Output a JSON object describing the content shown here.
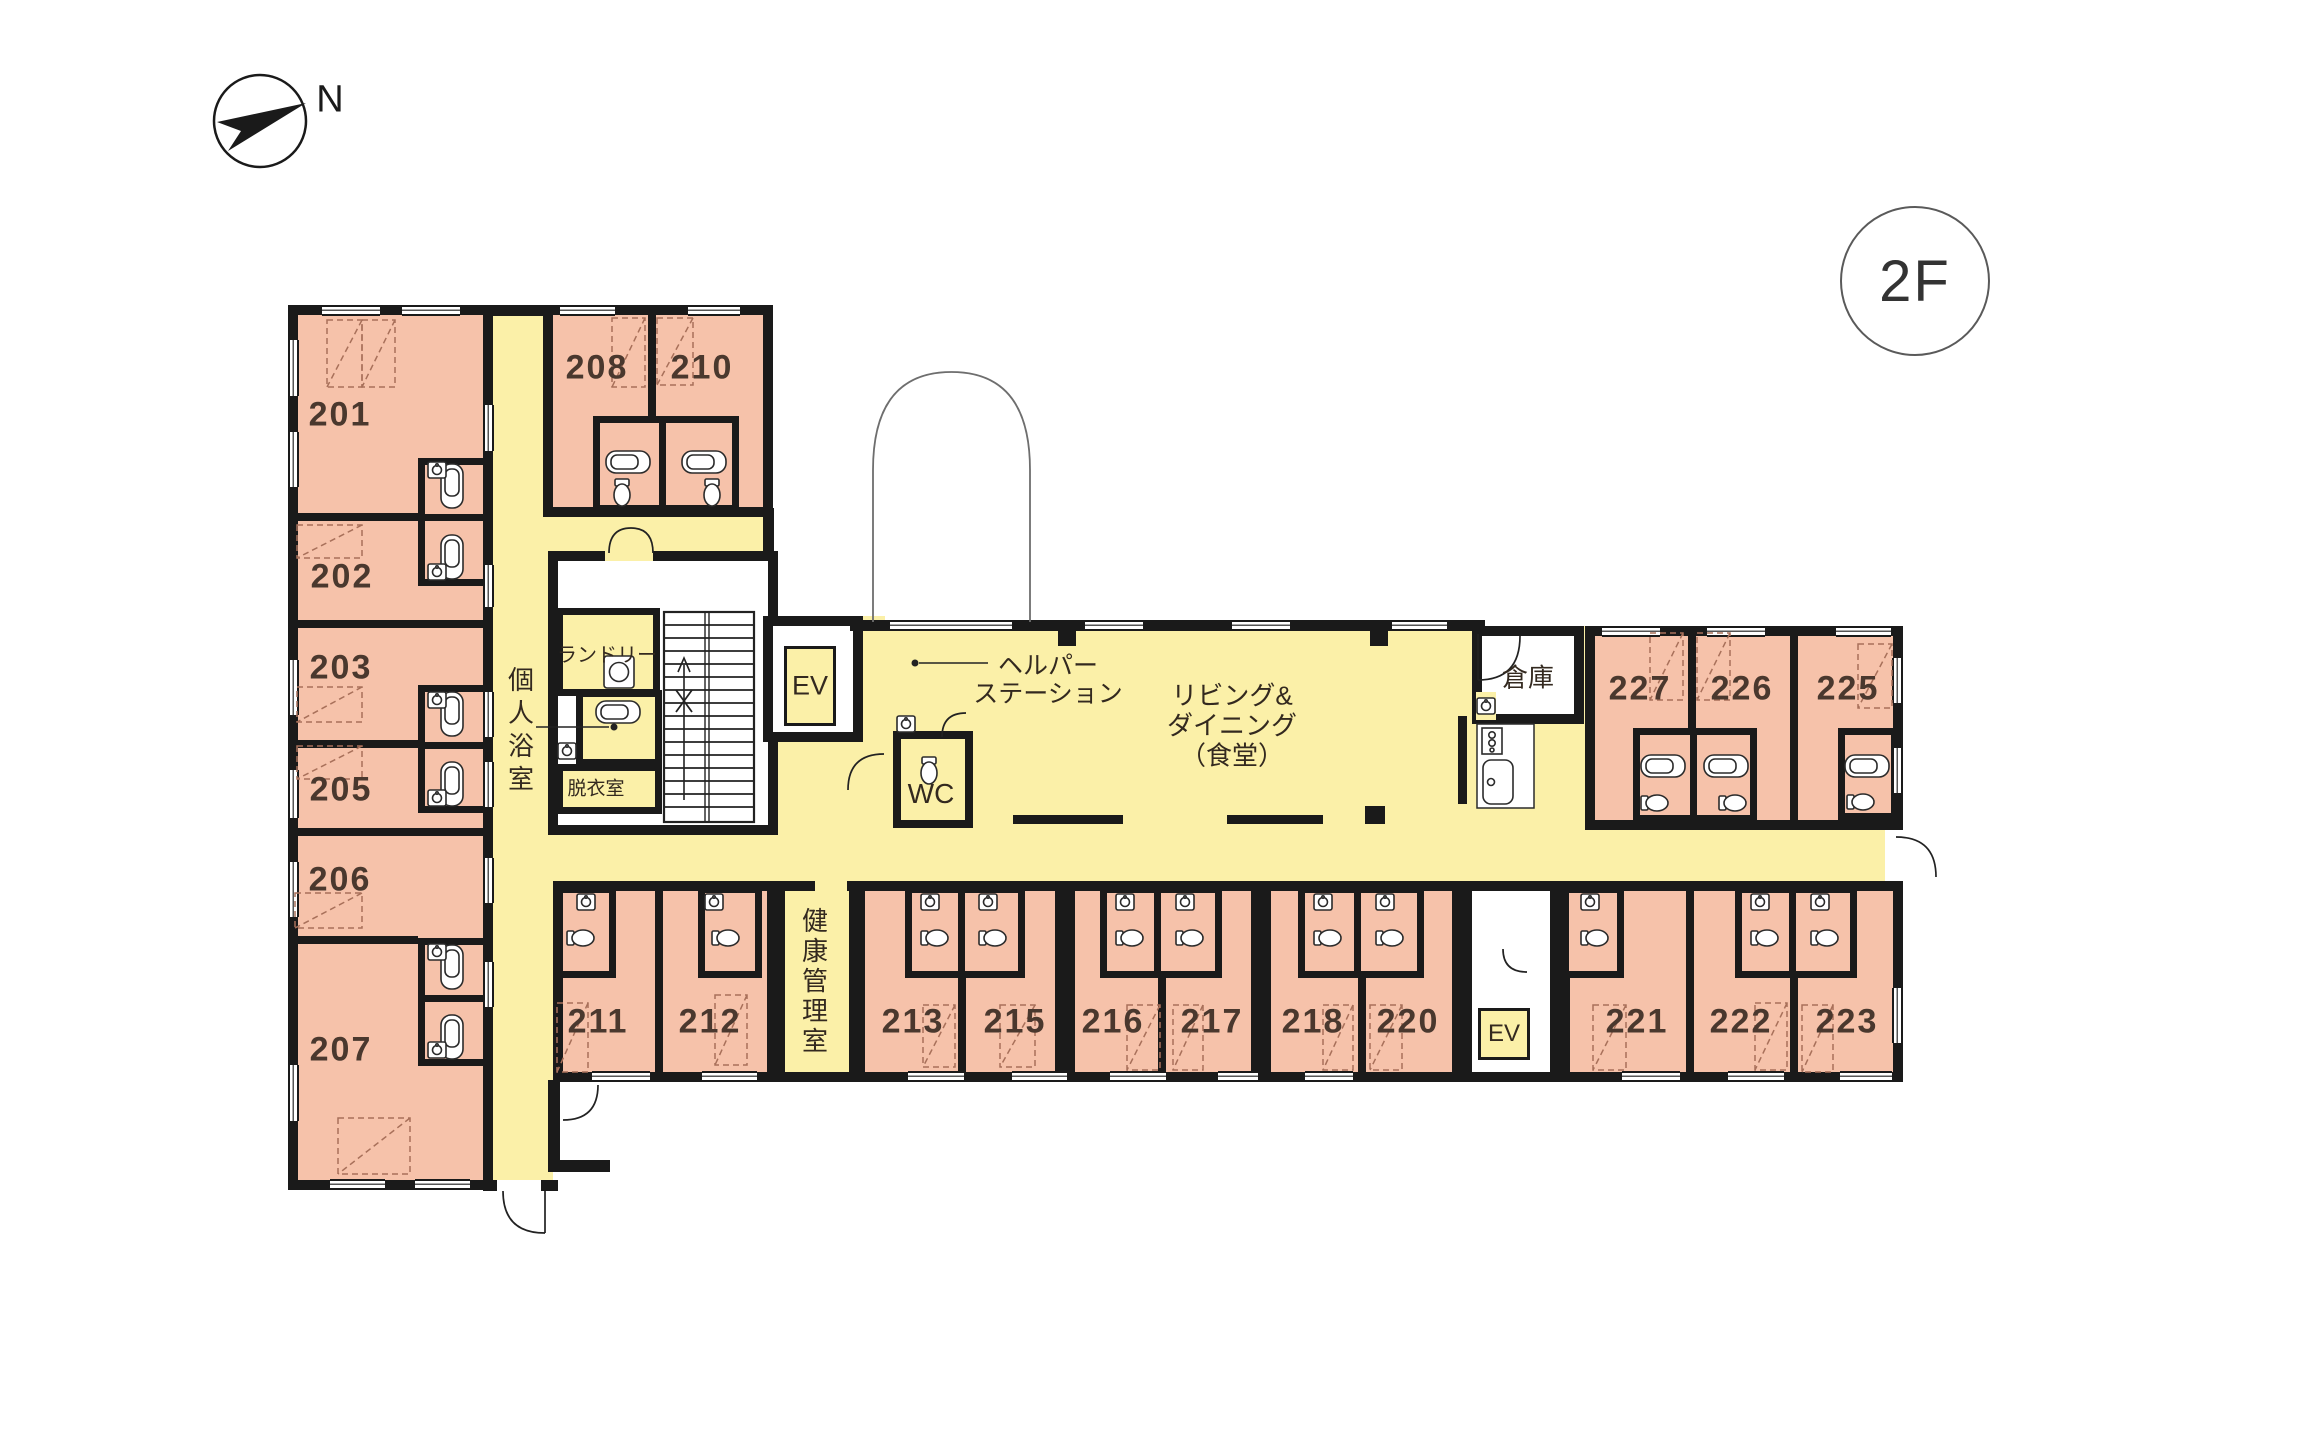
{
  "compass": {
    "north_label": "N"
  },
  "floor_badge": {
    "label": "2F"
  },
  "rooms": {
    "r201": "201",
    "r202": "202",
    "r203": "203",
    "r205": "205",
    "r206": "206",
    "r207": "207",
    "r208": "208",
    "r210": "210",
    "r211": "211",
    "r212": "212",
    "r213": "213",
    "r215": "215",
    "r216": "216",
    "r217": "217",
    "r218": "218",
    "r220": "220",
    "r221": "221",
    "r222": "222",
    "r223": "223",
    "r225": "225",
    "r226": "226",
    "r227": "227"
  },
  "areas": {
    "laundry": "ランドリー",
    "private_bath": "個人浴室",
    "dressing_room": "脱衣室",
    "elevator_main": "EV",
    "elevator_sub": "EV",
    "wc": "WC",
    "helper_station_line1": "ヘルパー",
    "helper_station_line2": "ステーション",
    "living_line1": "リビング&",
    "living_line2": "ダイニング",
    "living_line3": "（食堂）",
    "storage": "倉庫",
    "health_office": "健康管理室"
  },
  "colors": {
    "room_pink": "#f6c2aa",
    "common_yellow": "#fbf0a8",
    "wall_black": "#1a1a1a"
  }
}
